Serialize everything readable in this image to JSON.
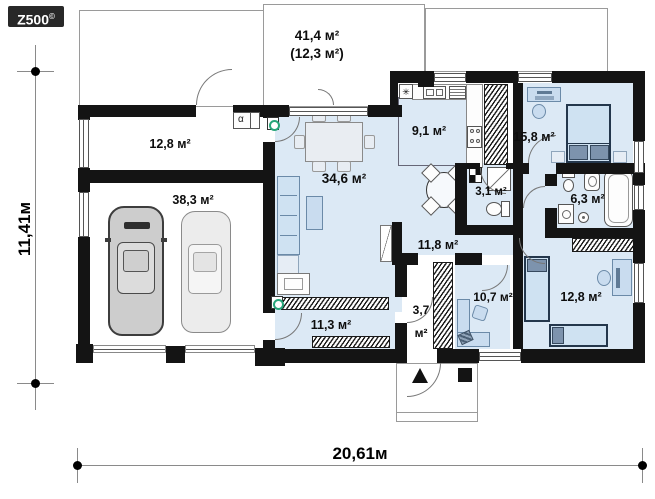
{
  "logo": {
    "brand": "Z500",
    "copyright": "©"
  },
  "dimensions": {
    "width_label": "20,61м",
    "height_label": "11,41м"
  },
  "floor_plan": {
    "rooms": [
      {
        "name": "terrace",
        "area": "41,4 м²",
        "area_secondary": "(12,3 м²)"
      },
      {
        "name": "utility-room",
        "area": "12,8 м²"
      },
      {
        "name": "garage",
        "area": "38,3 м²"
      },
      {
        "name": "living-room",
        "area": "34,6 м²"
      },
      {
        "name": "kitchen",
        "area": "9,1 м²"
      },
      {
        "name": "bedroom-top",
        "area": "15,8 м²"
      },
      {
        "name": "wc",
        "area": "3,1 м²"
      },
      {
        "name": "bathroom",
        "area": "6,3 м²"
      },
      {
        "name": "hallway",
        "area": "11,8 м²"
      },
      {
        "name": "bedroom-bottom-middle",
        "area": "10,7 м²"
      },
      {
        "name": "bedroom-bottom-right",
        "area": "12,8 м²"
      },
      {
        "name": "entry-hall",
        "area_line1": "3,7",
        "area_line2": "м²"
      },
      {
        "name": "wardrobe-room",
        "area": "11,3 м²"
      }
    ],
    "symbols": {
      "boiler": "α",
      "kitchen_marker": "✳"
    }
  },
  "colors": {
    "floor": "#dce9f5",
    "wall": "#141414",
    "furniture": "#c9dcef",
    "accent_green": "#27a57a"
  }
}
